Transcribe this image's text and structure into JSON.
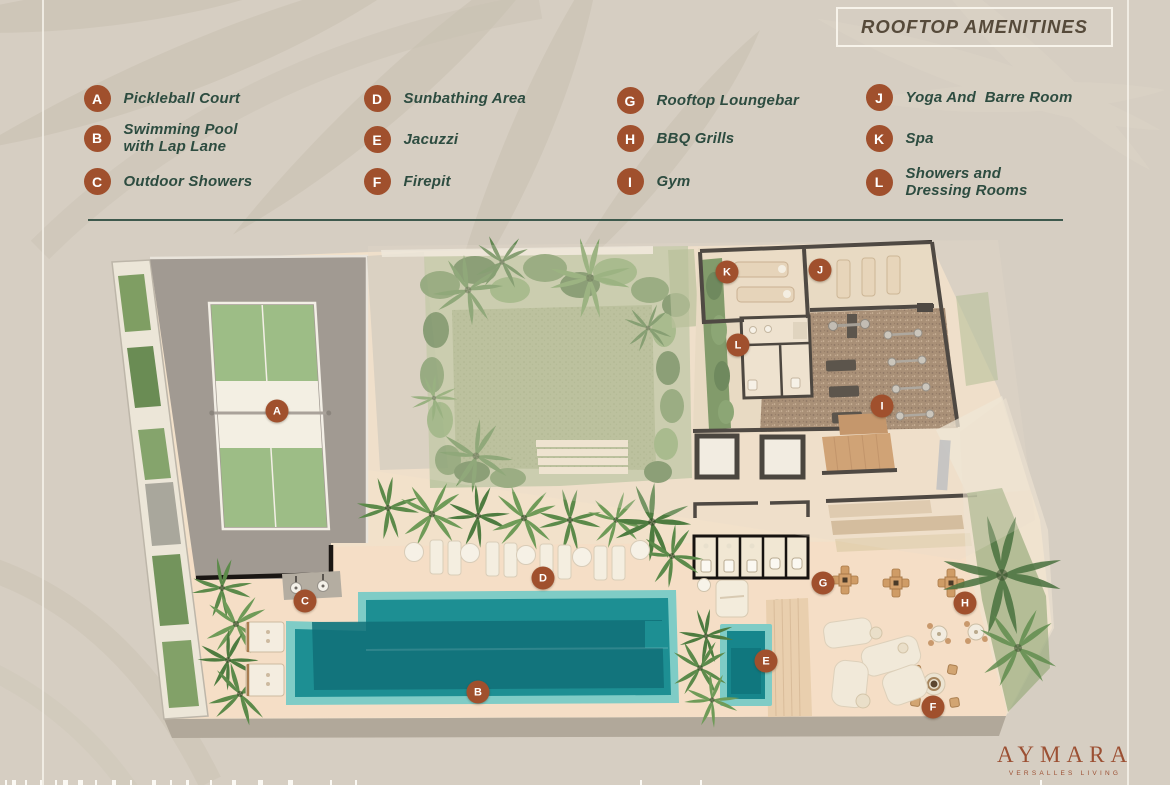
{
  "title": "ROOFTOP AMENITINES",
  "legend": {
    "columns": [
      [
        {
          "letter": "A",
          "label": "Pickleball Court"
        },
        {
          "letter": "B",
          "label": "Swimming Pool\nwith Lap Lane"
        },
        {
          "letter": "C",
          "label": "Outdoor Showers"
        }
      ],
      [
        {
          "letter": "D",
          "label": "Sunbathing Area"
        },
        {
          "letter": "E",
          "label": "Jacuzzi"
        },
        {
          "letter": "F",
          "label": "Firepit"
        }
      ],
      [
        {
          "letter": "G",
          "label": "Rooftop Loungebar"
        },
        {
          "letter": "H",
          "label": "BBQ Grills"
        },
        {
          "letter": "I",
          "label": "Gym"
        }
      ],
      [
        {
          "letter": "J",
          "label": "Yoga And  Barre Room"
        },
        {
          "letter": "K",
          "label": "Spa"
        },
        {
          "letter": "L",
          "label": "Showers and\nDressing Rooms"
        }
      ]
    ]
  },
  "plan_markers": [
    {
      "letter": "A",
      "x": 277,
      "y": 411
    },
    {
      "letter": "B",
      "x": 478,
      "y": 692
    },
    {
      "letter": "C",
      "x": 305,
      "y": 601
    },
    {
      "letter": "D",
      "x": 543,
      "y": 578
    },
    {
      "letter": "E",
      "x": 766,
      "y": 661
    },
    {
      "letter": "F",
      "x": 933,
      "y": 707
    },
    {
      "letter": "G",
      "x": 823,
      "y": 583
    },
    {
      "letter": "H",
      "x": 965,
      "y": 603
    },
    {
      "letter": "I",
      "x": 882,
      "y": 406
    },
    {
      "letter": "J",
      "x": 820,
      "y": 270
    },
    {
      "letter": "K",
      "x": 727,
      "y": 272
    },
    {
      "letter": "L",
      "x": 738,
      "y": 345
    }
  ],
  "brand": {
    "name": "AYMARA",
    "tagline": "VERSALLES LIVING"
  },
  "colors": {
    "badge": "#a0502d",
    "legend_text": "#2d4c40",
    "title_text": "#564a3a",
    "background": "#d6cec2",
    "divider": "#2d4c40",
    "logo": "#9c5033",
    "pool_water": "#1d8f93",
    "court_green": "#9dbd86"
  }
}
